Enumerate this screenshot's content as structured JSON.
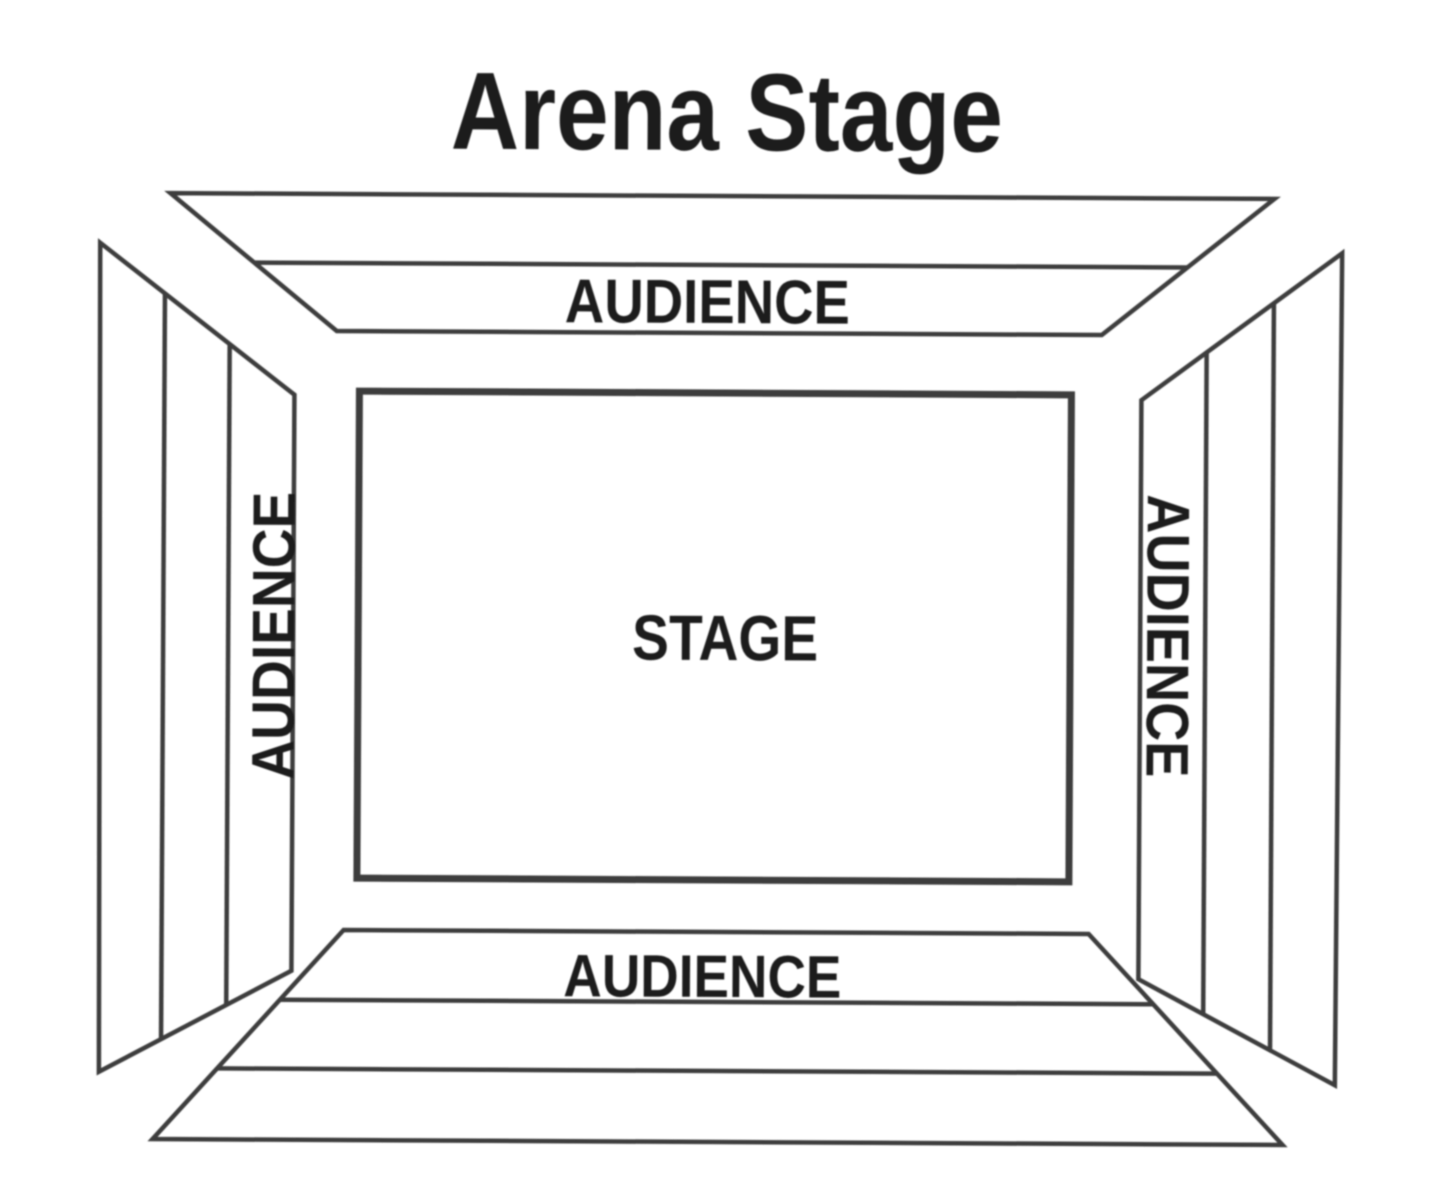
{
  "title": "Arena Stage",
  "stage": {
    "label": "STAGE"
  },
  "audience": {
    "top": "AUDIENCE",
    "bottom": "AUDIENCE",
    "left": "AUDIENCE",
    "right": "AUDIENCE"
  },
  "colors": {
    "background": "#ffffff",
    "line": "#3c3c3c",
    "text": "#1e1e1e"
  }
}
